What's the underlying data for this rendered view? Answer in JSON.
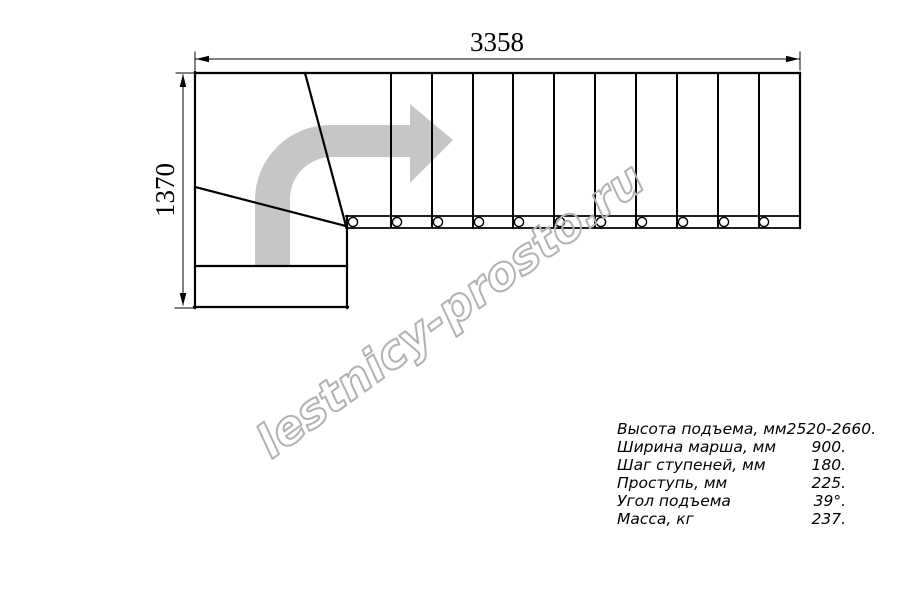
{
  "page": {
    "background": "#ffffff",
    "description": "Top-view technical plan drawing of an L-shaped staircase with winder steps"
  },
  "watermark": {
    "text": "lestnicy-prosto.ru",
    "color": "#b2b2b2"
  },
  "dimensions": {
    "width_label": "3358",
    "height_label": "1370"
  },
  "specs": {
    "rows": [
      {
        "label": "Высота подъема, мм",
        "value": "2520-2660."
      },
      {
        "label": "Ширина марша, мм",
        "value": "900."
      },
      {
        "label": "Шаг ступеней, мм",
        "value": "180."
      },
      {
        "label": "Проступь, мм",
        "value": "225."
      },
      {
        "label": "Угол подъема",
        "value": "39°."
      },
      {
        "label": "Масса, кг",
        "value": "237."
      }
    ]
  },
  "diagram": {
    "type": "staircase-plan-top-view",
    "line_color": "#000000",
    "direction_arrow_color": "#c6c6c6",
    "straight_flight_tread_count": 11,
    "tread_line_xs": [
      391,
      432,
      473,
      513,
      554,
      595,
      636,
      677,
      718,
      759
    ],
    "tread_line_y_top": 73,
    "tread_line_y_bottom": 228,
    "baluster_circle_xs": [
      353,
      397,
      438,
      479,
      519,
      560,
      601,
      642,
      683,
      724,
      764
    ],
    "baluster_circle_cy": 222,
    "baluster_circle_r": 4.6
  }
}
